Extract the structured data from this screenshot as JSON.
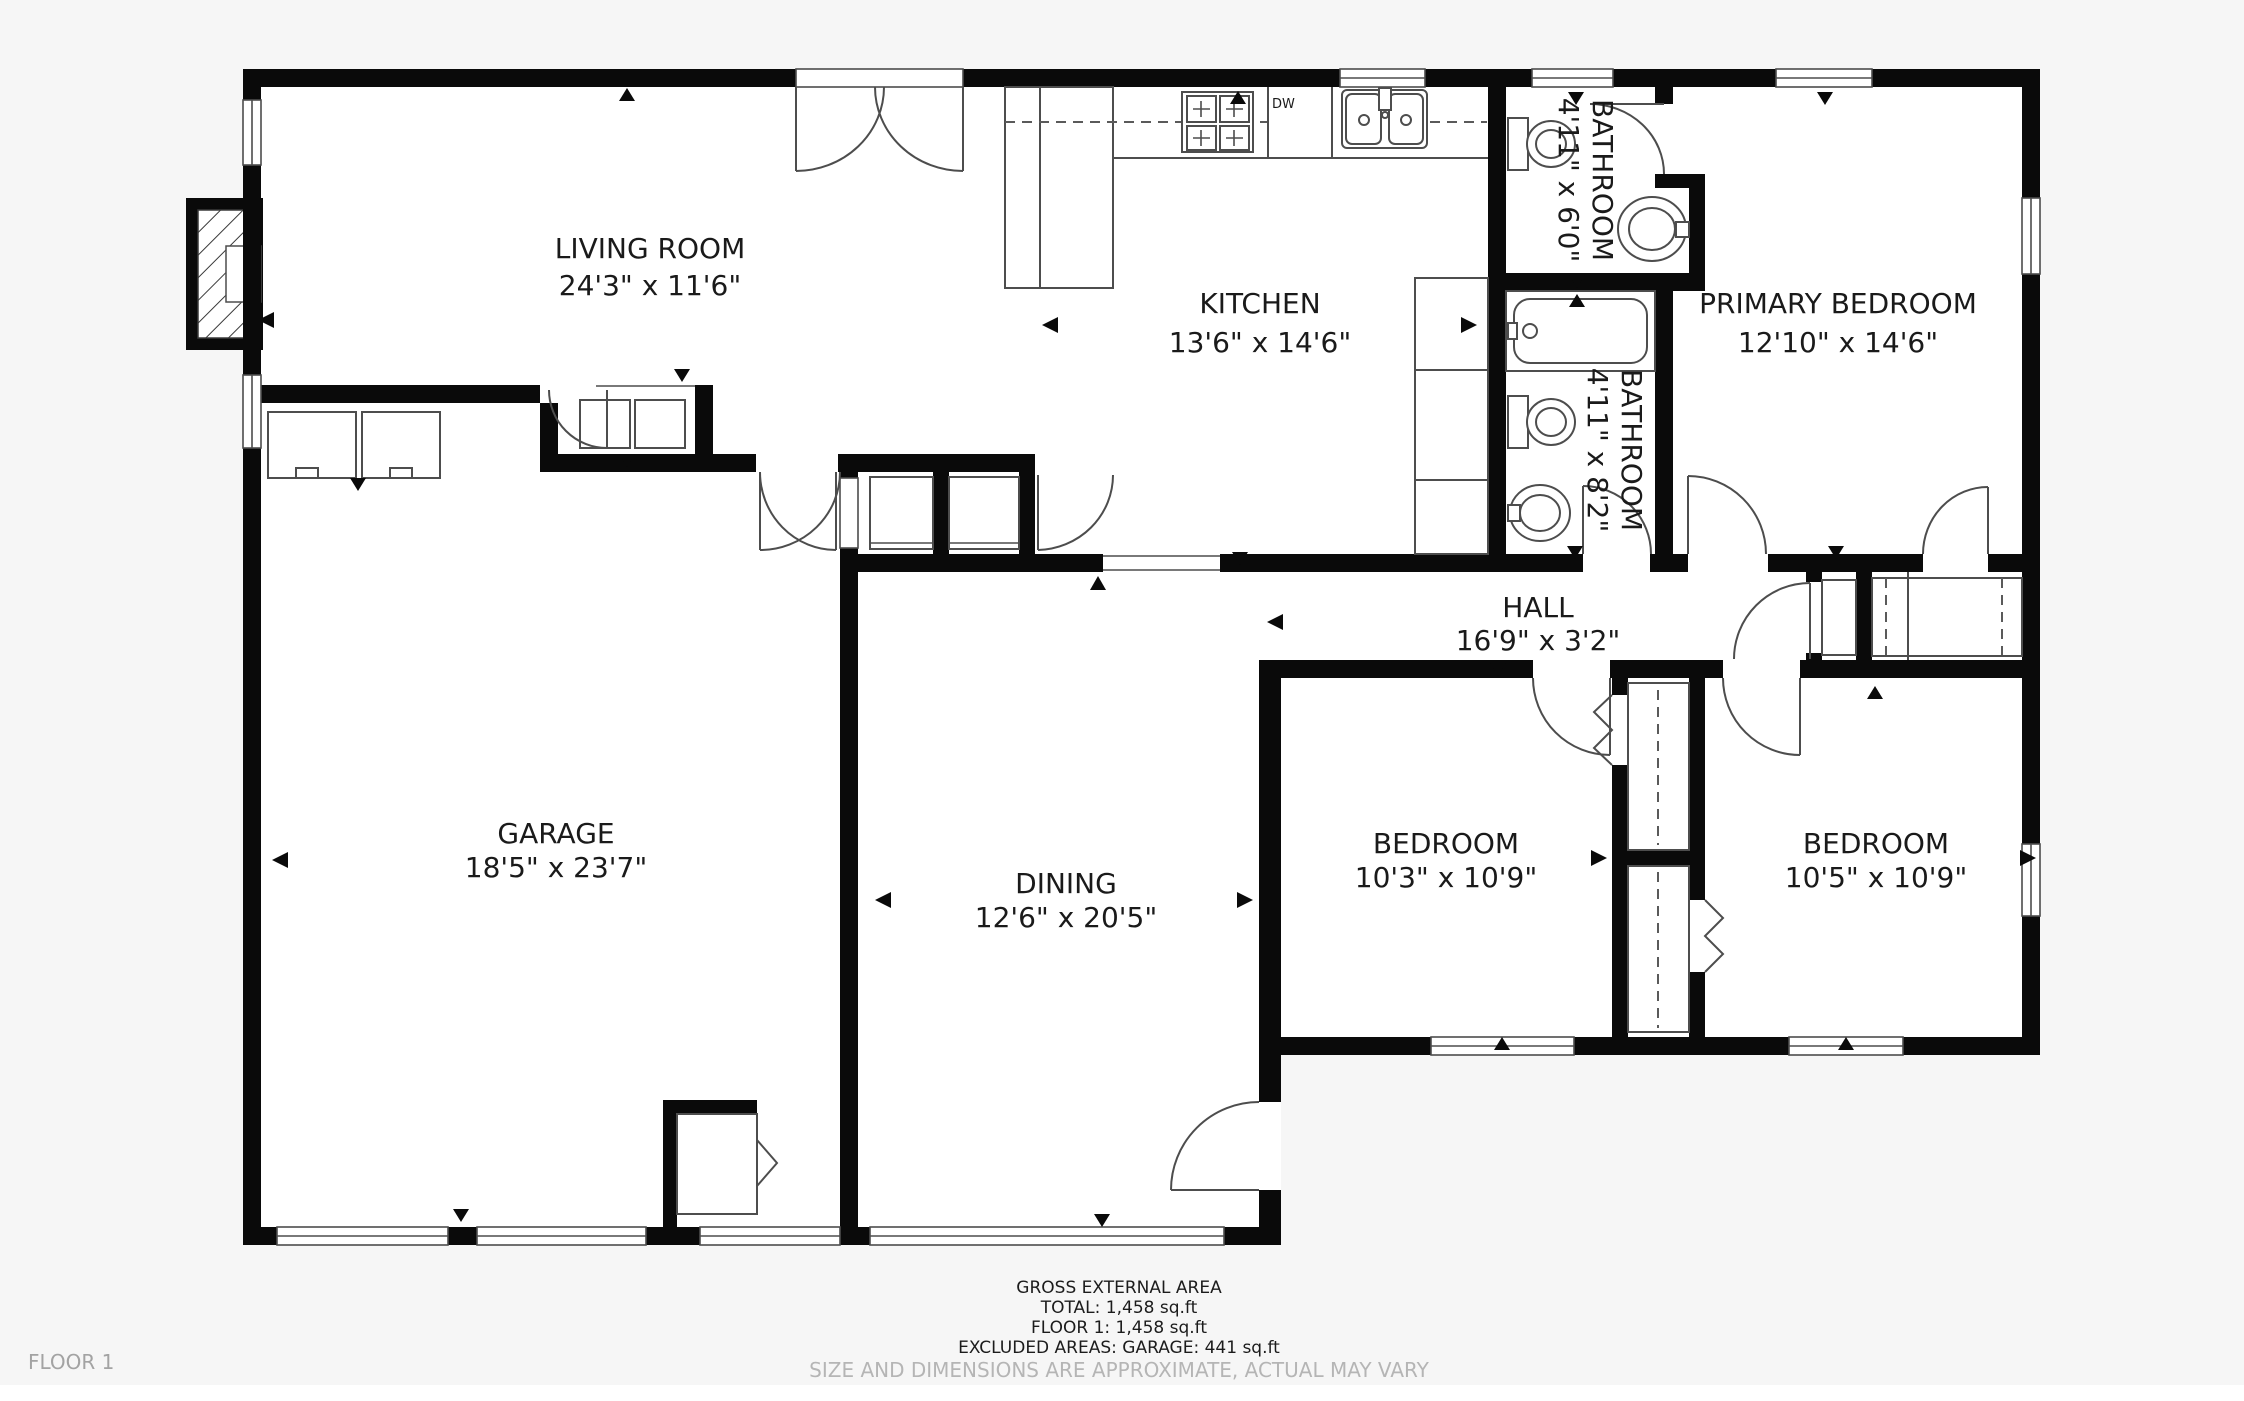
{
  "floor_label": "FLOOR 1",
  "rooms": [
    {
      "id": "living-room",
      "name": "LIVING ROOM",
      "dims": "24'3\" x 11'6\""
    },
    {
      "id": "kitchen",
      "name": "KITCHEN",
      "dims": "13'6\" x 14'6\""
    },
    {
      "id": "bathroom-top",
      "name": "BATHROOM",
      "dims": "4'11\" x 6'0\""
    },
    {
      "id": "primary-bedroom",
      "name": "PRIMARY BEDROOM",
      "dims": "12'10\" x 14'6\""
    },
    {
      "id": "bathroom-hall",
      "name": "BATHROOM",
      "dims": "4'11\" x 8'2\""
    },
    {
      "id": "hall",
      "name": "HALL",
      "dims": "16'9\" x 3'2\""
    },
    {
      "id": "garage",
      "name": "GARAGE",
      "dims": "18'5\" x 23'7\""
    },
    {
      "id": "dining",
      "name": "DINING",
      "dims": "12'6\" x 20'5\""
    },
    {
      "id": "bedroom-left",
      "name": "BEDROOM",
      "dims": "10'3\" x 10'9\""
    },
    {
      "id": "bedroom-right",
      "name": "BEDROOM",
      "dims": "10'5\" x 10'9\""
    }
  ],
  "appliances": {
    "dishwasher_label": "DW"
  },
  "footer": {
    "title": "GROSS EXTERNAL AREA",
    "total": "TOTAL: 1,458 sq.ft",
    "floor": "FLOOR 1: 1,458 sq.ft",
    "excluded": "EXCLUDED AREAS: GARAGE: 441 sq.ft",
    "disclaimer": "SIZE AND DIMENSIONS ARE APPROXIMATE, ACTUAL MAY VARY"
  },
  "colors": {
    "wall": "#0a0a0a",
    "thin_line": "#4d4d4d",
    "background": "#f6f6f6",
    "floor": "#ffffff",
    "label_text": "#1a1a1a",
    "muted_text": "#b5b5b5"
  }
}
